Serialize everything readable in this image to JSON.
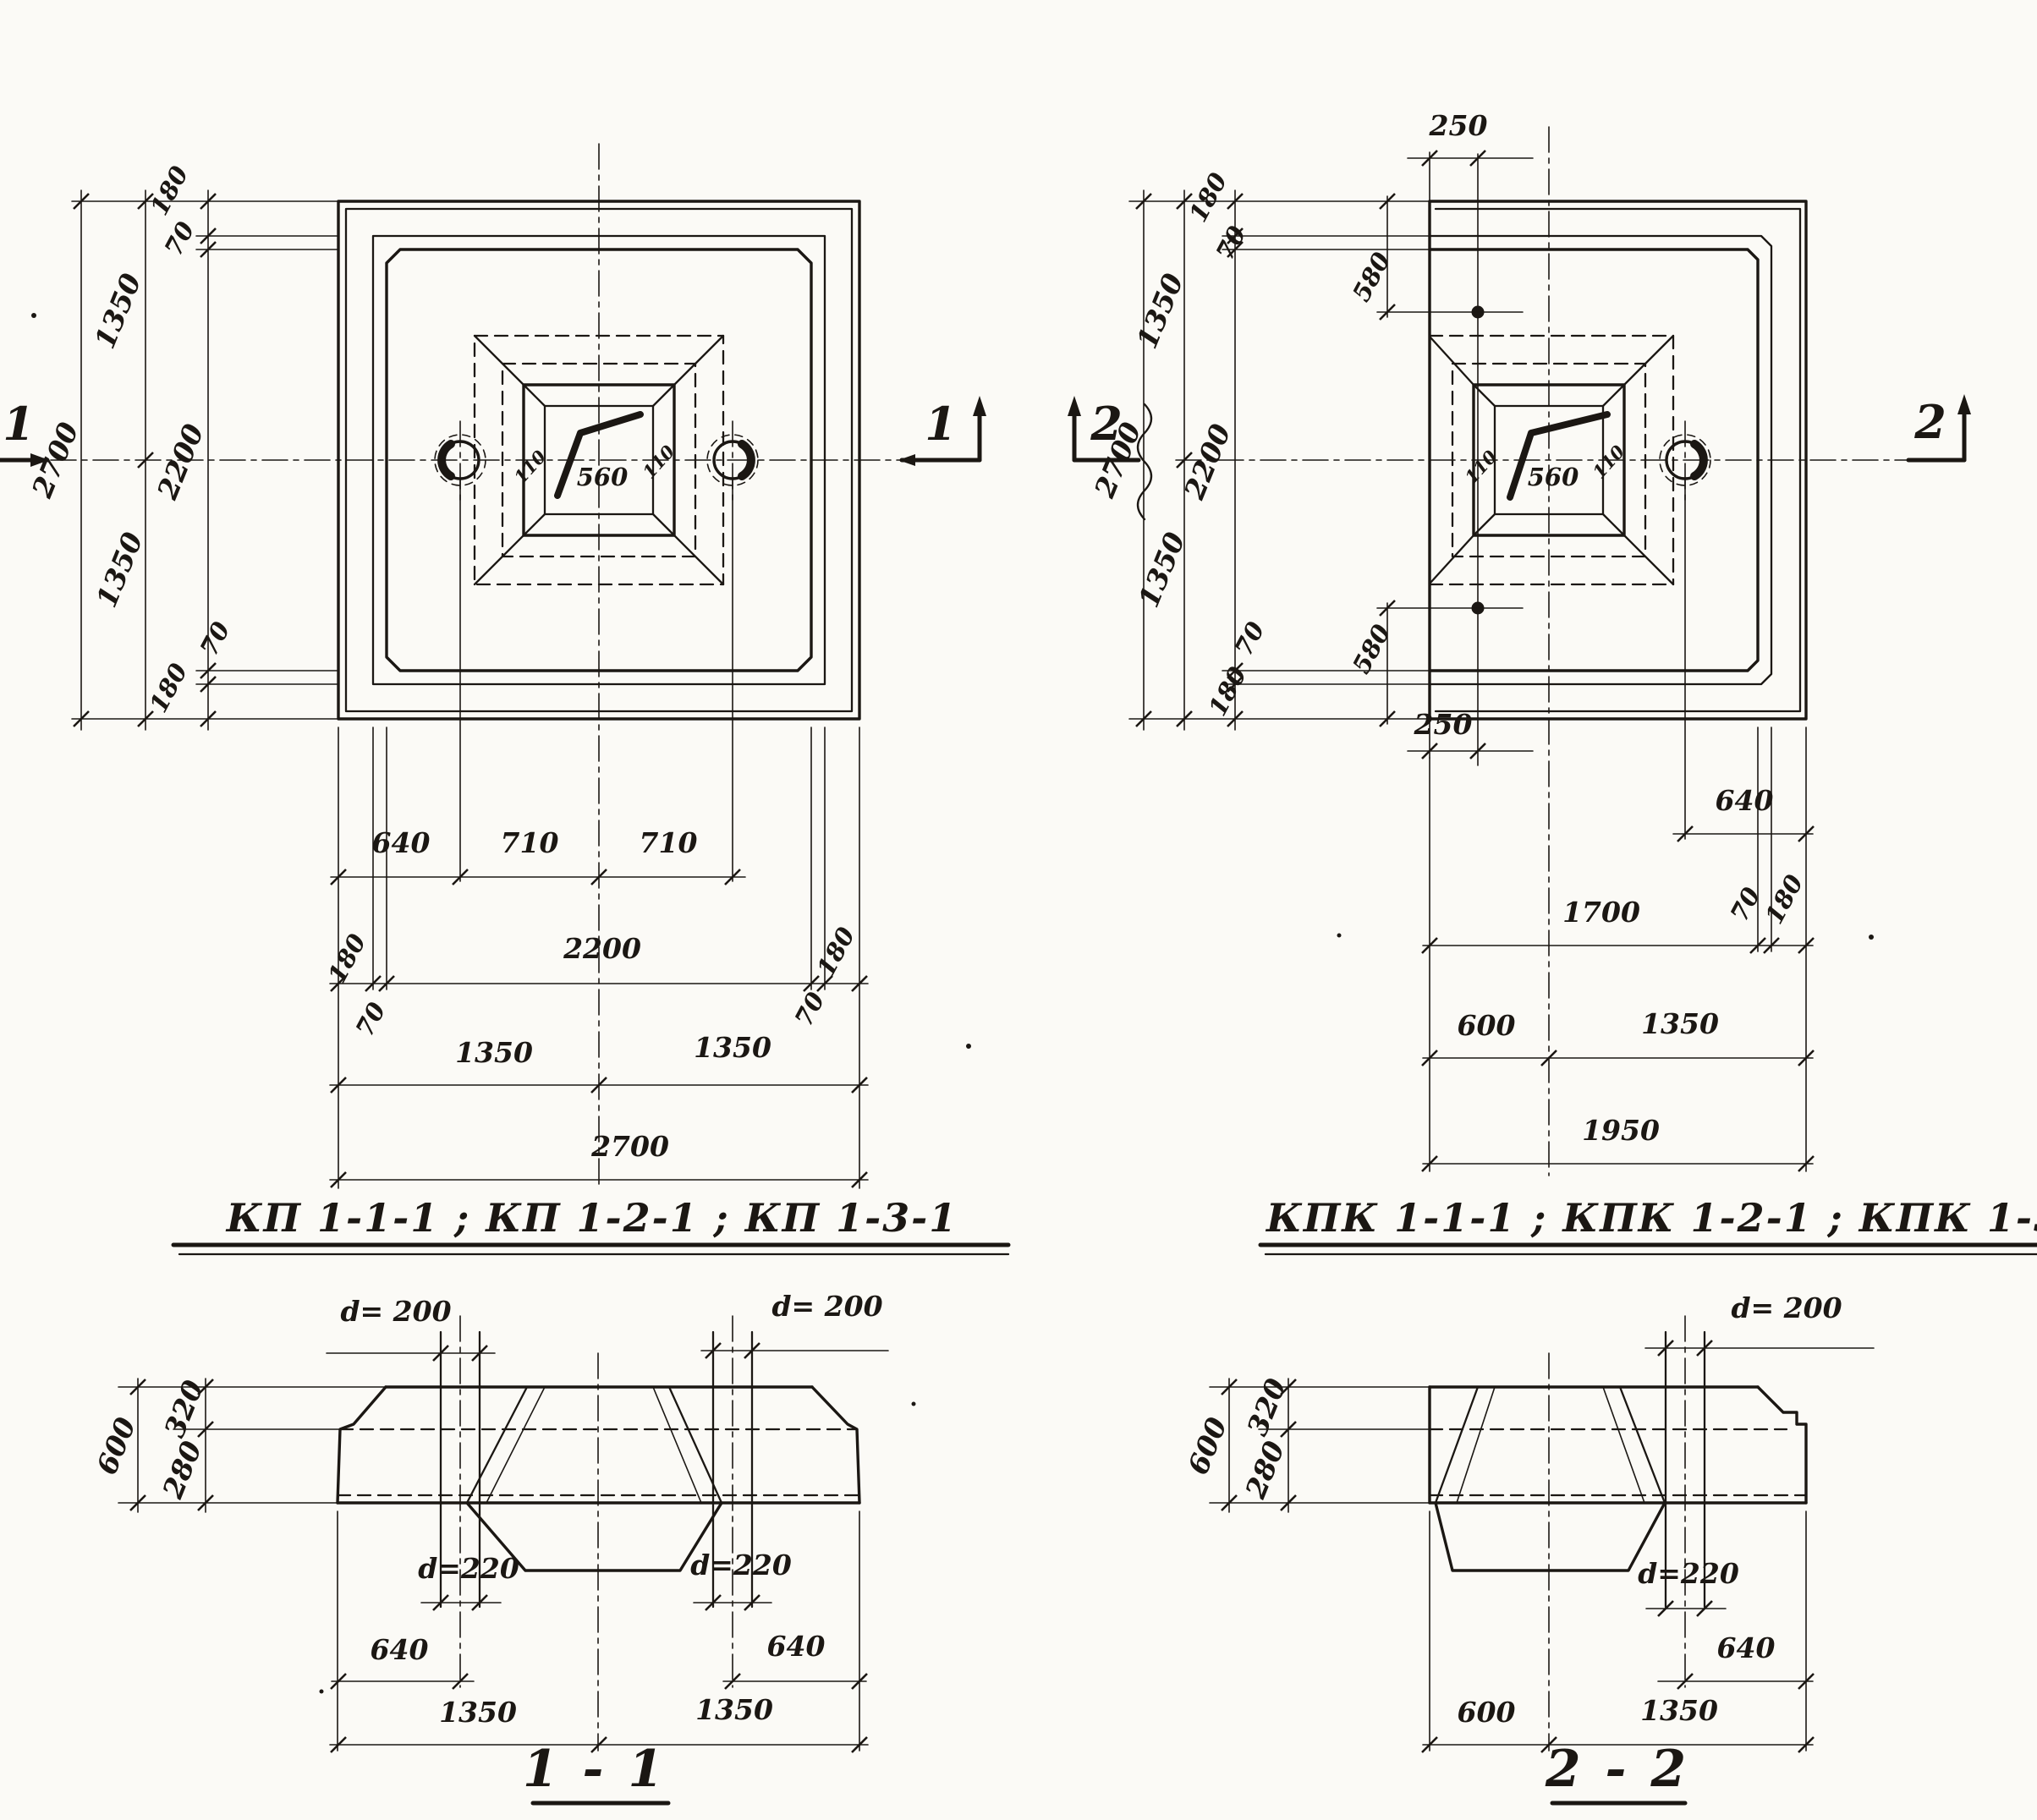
{
  "plan_left": {
    "title": "КП 1-1-1 ; КП 1-2-1 ; КП 1-3-1",
    "dim_overall": "2700",
    "dim_half": "1350",
    "dim_inner": "2200",
    "dim_edge": "180",
    "dim_rib": "70",
    "dim_hole_offset": "640",
    "dim_hole_spacing": "710",
    "socket_width": "560",
    "socket_wall": "110"
  },
  "plan_right": {
    "title": "КПК 1-1-1 ; КПК 1-2-1 ; КПК 1-3-1",
    "dim_overall_h": "2700",
    "dim_half": "1350",
    "dim_inner_h": "2200",
    "dim_edge": "180",
    "dim_rib": "70",
    "dim_hole_x": "250",
    "dim_hole_y": "580",
    "dim_hole_offset": "640",
    "dim_inner_w": "1700",
    "dim_socket_offset": "600",
    "dim_overall_w": "1950",
    "socket_width": "560",
    "socket_wall": "110"
  },
  "section_1": {
    "label": "1 - 1",
    "hole_top": "d= 200",
    "hole_bottom": "d=220",
    "height": "600",
    "upper": "320",
    "lower": "280",
    "hole_offset": "640",
    "half": "1350"
  },
  "section_2": {
    "label": "2 - 2",
    "hole_top": "d= 200",
    "hole_bottom": "d=220",
    "height": "600",
    "upper": "320",
    "lower": "280",
    "hole_offset": "640",
    "socket_offset": "600",
    "half": "1350"
  },
  "section_marks": {
    "s1": "1",
    "s2": "2"
  }
}
